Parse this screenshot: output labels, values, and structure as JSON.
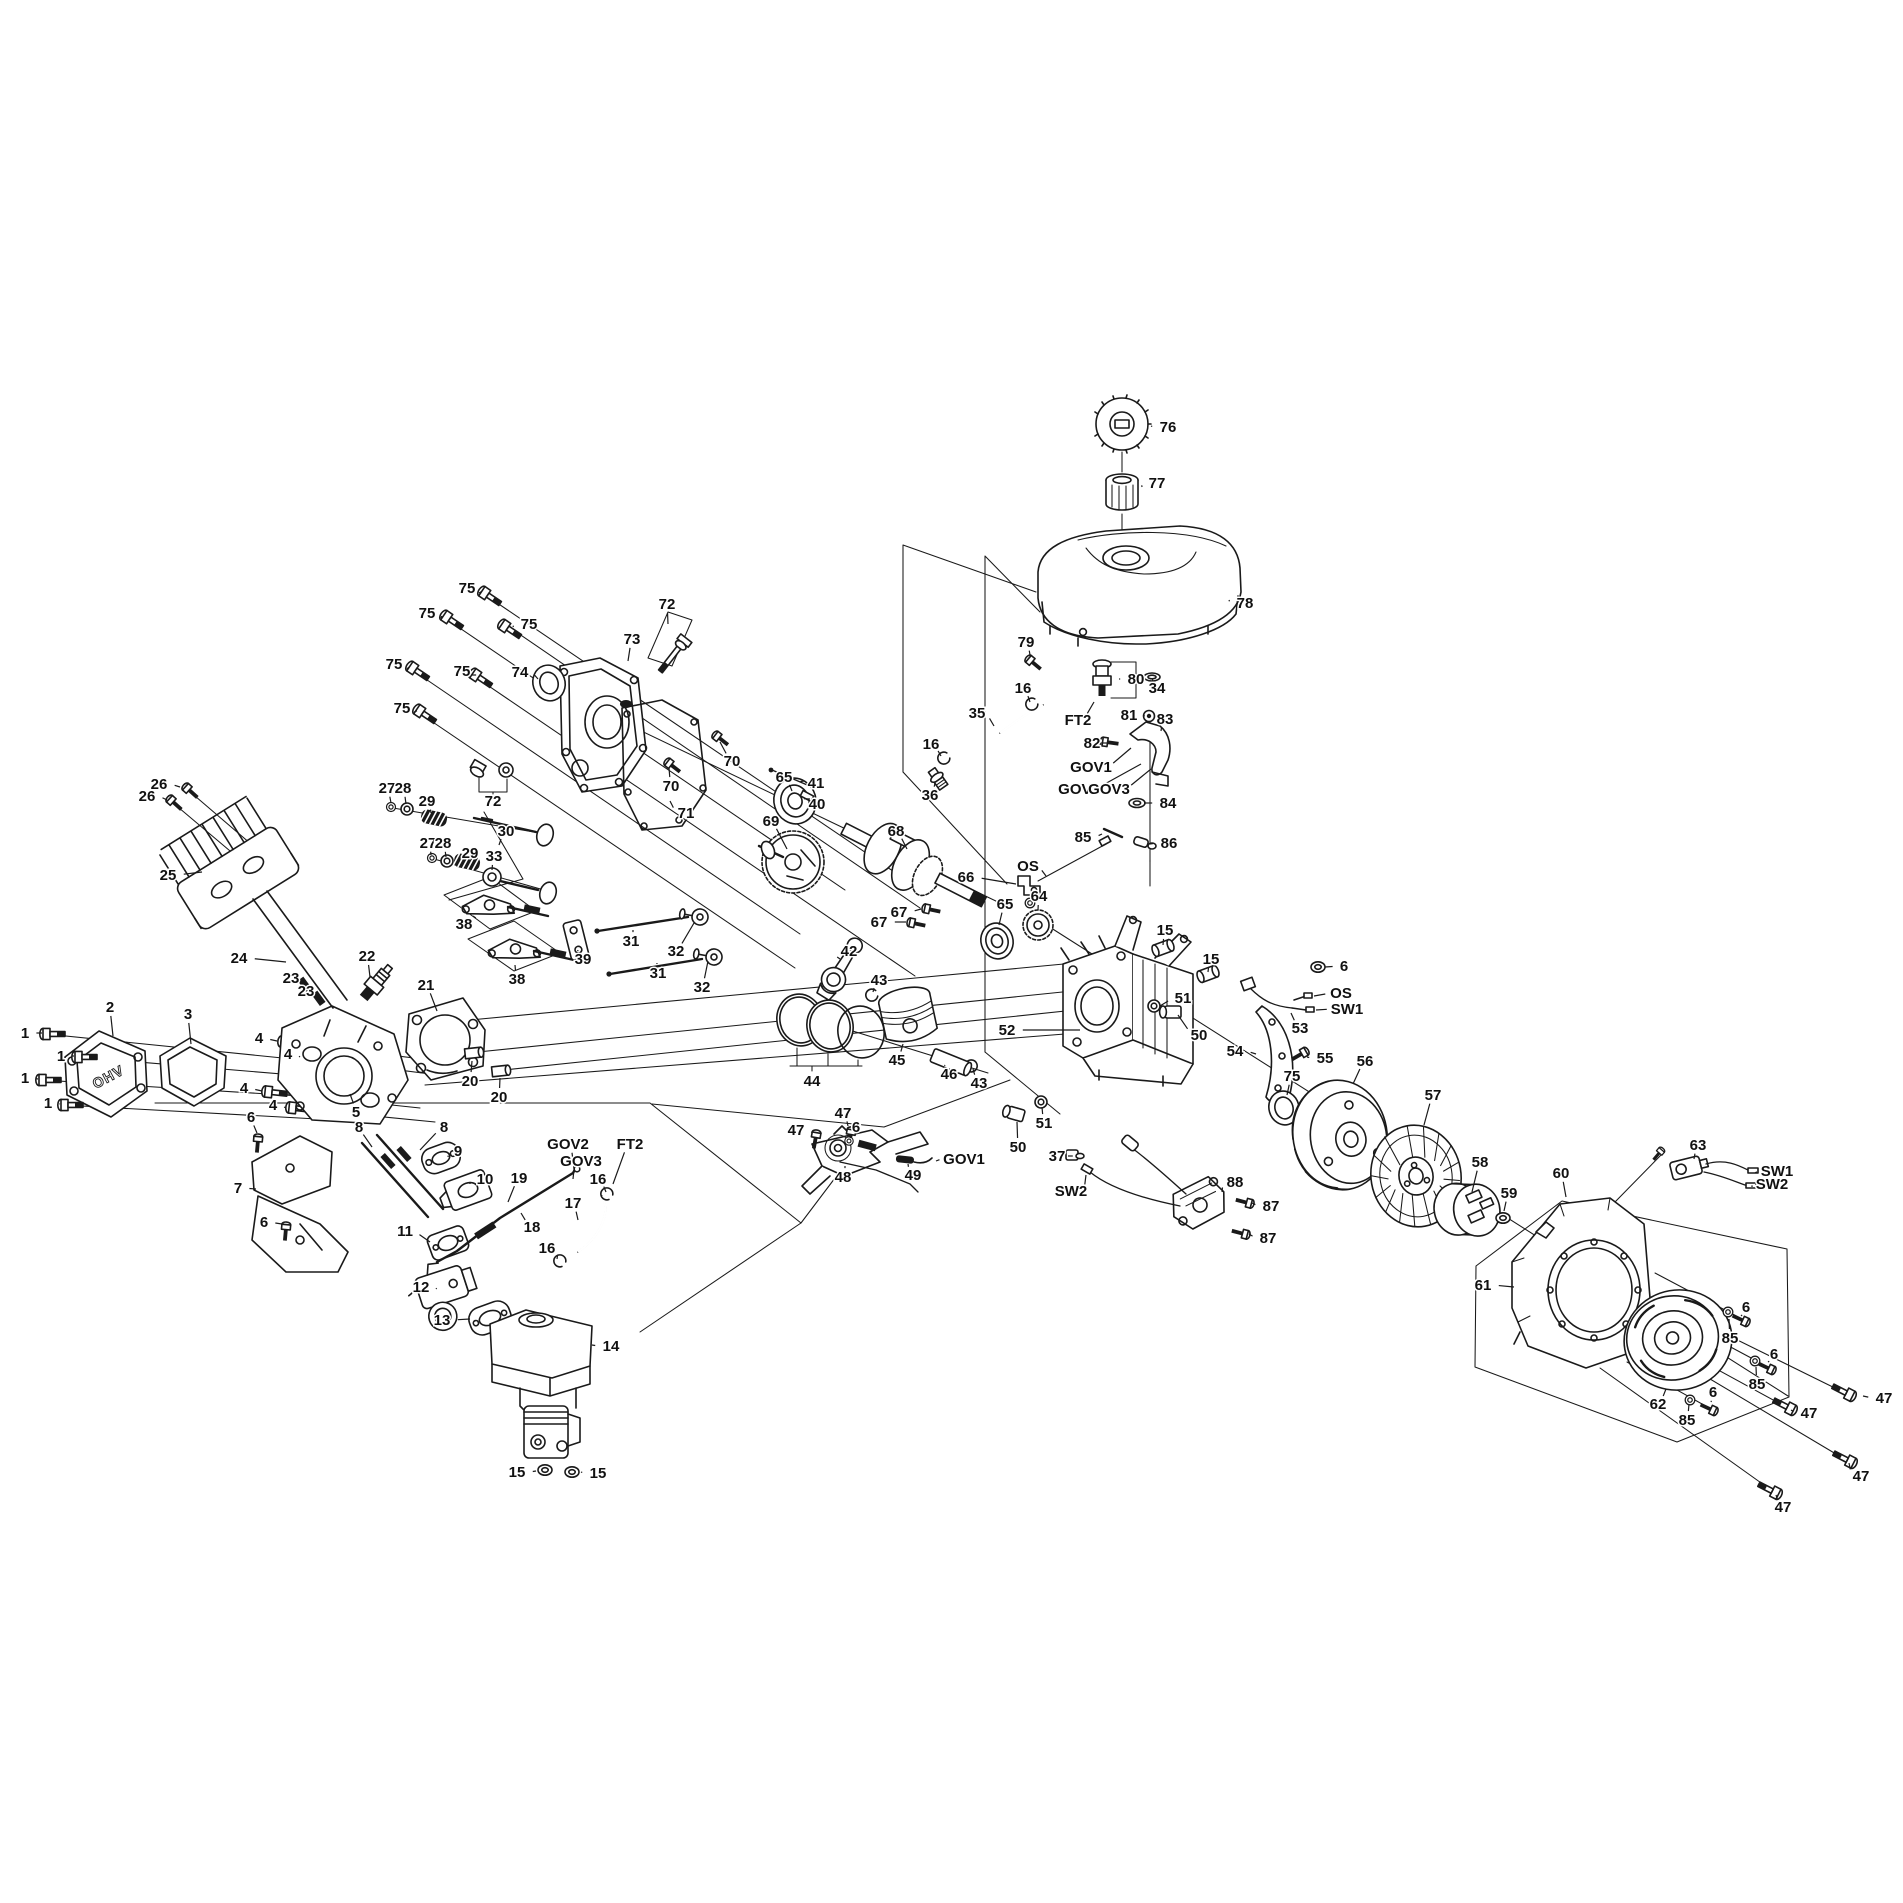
{
  "diagram": {
    "kind": "exploded-parts-diagram",
    "background": "#ffffff",
    "line_color": "#1a1a1a",
    "label_color": "#111111",
    "label_font_size": 15,
    "cover_text": "OHV"
  },
  "callouts": [
    {
      "t": "1",
      "x": 25,
      "y": 1033,
      "lx": 42,
      "ly": 1033
    },
    {
      "t": "1",
      "x": 61,
      "y": 1056,
      "lx": 74,
      "ly": 1056
    },
    {
      "t": "1",
      "x": 25,
      "y": 1078,
      "lx": 38,
      "ly": 1079
    },
    {
      "t": "1",
      "x": 48,
      "y": 1103,
      "lx": 60,
      "ly": 1104
    },
    {
      "t": "2",
      "x": 110,
      "y": 1007,
      "lx": 113,
      "ly": 1036
    },
    {
      "t": "3",
      "x": 188,
      "y": 1014,
      "lx": 191,
      "ly": 1044
    },
    {
      "t": "4",
      "x": 259,
      "y": 1038,
      "lx": 277,
      "ly": 1041
    },
    {
      "t": "4",
      "x": 288,
      "y": 1054,
      "lx": 300,
      "ly": 1057
    },
    {
      "t": "4",
      "x": 244,
      "y": 1088,
      "lx": 262,
      "ly": 1091
    },
    {
      "t": "4",
      "x": 273,
      "y": 1105,
      "lx": 286,
      "ly": 1108
    },
    {
      "t": "5",
      "x": 356,
      "y": 1112,
      "lx": 350,
      "ly": 1094
    },
    {
      "t": "6",
      "x": 251,
      "y": 1117,
      "lx": 257,
      "ly": 1133
    },
    {
      "t": "6",
      "x": 264,
      "y": 1222,
      "lx": 282,
      "ly": 1224
    },
    {
      "t": "6",
      "x": 856,
      "y": 1127,
      "lx": 850,
      "ly": 1138
    },
    {
      "t": "7",
      "x": 238,
      "y": 1188,
      "lx": 256,
      "ly": 1189
    },
    {
      "t": "8",
      "x": 359,
      "y": 1127,
      "lx": 372,
      "ly": 1147
    },
    {
      "t": "8",
      "x": 444,
      "y": 1127,
      "lx": 420,
      "ly": 1150
    },
    {
      "t": "9",
      "x": 458,
      "y": 1151,
      "lx": 448,
      "ly": 1157
    },
    {
      "t": "10",
      "x": 485,
      "y": 1179,
      "lx": 470,
      "ly": 1184
    },
    {
      "t": "11",
      "x": 405,
      "y": 1231,
      "lx": 430,
      "ly": 1242
    },
    {
      "t": "12",
      "x": 421,
      "y": 1287,
      "lx": 436,
      "ly": 1289
    },
    {
      "t": "13",
      "x": 442,
      "y": 1320,
      "lx": 470,
      "ly": 1319
    },
    {
      "t": "14",
      "x": 611,
      "y": 1346,
      "lx": 592,
      "ly": 1345
    },
    {
      "t": "15",
      "x": 517,
      "y": 1472,
      "lx": 536,
      "ly": 1471
    },
    {
      "t": "15",
      "x": 598,
      "y": 1473,
      "lx": 581,
      "ly": 1472
    },
    {
      "t": "15",
      "x": 1165,
      "y": 930,
      "lx": 1163,
      "ly": 945
    },
    {
      "t": "15",
      "x": 1211,
      "y": 959,
      "lx": 1208,
      "ly": 972
    },
    {
      "t": "16",
      "x": 1023,
      "y": 688,
      "lx": 1030,
      "ly": 702
    },
    {
      "t": "16",
      "x": 931,
      "y": 744,
      "lx": 941,
      "ly": 756
    },
    {
      "t": "16",
      "x": 598,
      "y": 1179,
      "lx": 606,
      "ly": 1192
    },
    {
      "t": "16",
      "x": 547,
      "y": 1248,
      "lx": 557,
      "ly": 1259
    },
    {
      "t": "17",
      "x": 573,
      "y": 1203,
      "lx": 578,
      "ly": 1220
    },
    {
      "t": "18",
      "x": 532,
      "y": 1227,
      "lx": 521,
      "ly": 1213
    },
    {
      "t": "19",
      "x": 519,
      "y": 1178,
      "lx": 508,
      "ly": 1202
    },
    {
      "t": "20",
      "x": 470,
      "y": 1081,
      "lx": 472,
      "ly": 1061
    },
    {
      "t": "20",
      "x": 499,
      "y": 1097,
      "lx": 500,
      "ly": 1078
    },
    {
      "t": "21",
      "x": 426,
      "y": 985,
      "lx": 437,
      "ly": 1011
    },
    {
      "t": "22",
      "x": 367,
      "y": 956,
      "lx": 370,
      "ly": 977
    },
    {
      "t": "23",
      "x": 291,
      "y": 978,
      "lx": 304,
      "ly": 988
    },
    {
      "t": "23",
      "x": 306,
      "y": 991,
      "lx": 318,
      "ly": 1001
    },
    {
      "t": "24",
      "x": 239,
      "y": 958,
      "lx": 286,
      "ly": 962
    },
    {
      "t": "25",
      "x": 168,
      "y": 875,
      "lx": 202,
      "ly": 872
    },
    {
      "t": "26",
      "x": 159,
      "y": 784,
      "lx": 180,
      "ly": 787
    },
    {
      "t": "26",
      "x": 147,
      "y": 796,
      "lx": 167,
      "ly": 800
    },
    {
      "t": "27",
      "x": 387,
      "y": 788,
      "lx": 391,
      "ly": 803
    },
    {
      "t": "27",
      "x": 428,
      "y": 843,
      "lx": 431,
      "ly": 855
    },
    {
      "t": "28",
      "x": 403,
      "y": 788,
      "lx": 406,
      "ly": 804
    },
    {
      "t": "28",
      "x": 443,
      "y": 843,
      "lx": 446,
      "ly": 857
    },
    {
      "t": "29",
      "x": 427,
      "y": 801,
      "lx": 431,
      "ly": 813
    },
    {
      "t": "29",
      "x": 470,
      "y": 853,
      "lx": 467,
      "ly": 858
    },
    {
      "t": "30",
      "x": 506,
      "y": 831,
      "lx": 499,
      "ly": 845
    },
    {
      "t": "31",
      "x": 631,
      "y": 941,
      "lx": 633,
      "ly": 930
    },
    {
      "t": "31",
      "x": 658,
      "y": 973,
      "lx": 657,
      "ly": 963
    },
    {
      "t": "32",
      "x": 676,
      "y": 951,
      "lx": 694,
      "ly": 923
    },
    {
      "t": "32",
      "x": 702,
      "y": 987,
      "lx": 708,
      "ly": 961
    },
    {
      "t": "33",
      "x": 494,
      "y": 856,
      "lx": 492,
      "ly": 870
    },
    {
      "t": "34",
      "x": 1157,
      "y": 688,
      "lx": 1153,
      "ly": 680
    },
    {
      "t": "35",
      "x": 977,
      "y": 713,
      "lx": 994,
      "ly": 726
    },
    {
      "t": "36",
      "x": 930,
      "y": 795,
      "lx": 935,
      "ly": 783
    },
    {
      "t": "37",
      "x": 1057,
      "y": 1156,
      "lx": 1068,
      "ly": 1156
    },
    {
      "t": "38",
      "x": 464,
      "y": 924,
      "lx": 473,
      "ly": 916
    },
    {
      "t": "38",
      "x": 517,
      "y": 979,
      "lx": 515,
      "ly": 965
    },
    {
      "t": "39",
      "x": 583,
      "y": 959,
      "lx": 578,
      "ly": 950
    },
    {
      "t": "40",
      "x": 817,
      "y": 804,
      "lx": 810,
      "ly": 799
    },
    {
      "t": "41",
      "x": 816,
      "y": 783,
      "lx": 804,
      "ly": 781
    },
    {
      "t": "42",
      "x": 849,
      "y": 951,
      "lx": 840,
      "ly": 959
    },
    {
      "t": "43",
      "x": 879,
      "y": 980,
      "lx": 873,
      "ly": 992
    },
    {
      "t": "43",
      "x": 979,
      "y": 1083,
      "lx": 973,
      "ly": 1069
    },
    {
      "t": "44",
      "x": 812,
      "y": 1081,
      "lx": null,
      "ly": null
    },
    {
      "t": "45",
      "x": 897,
      "y": 1060,
      "lx": 903,
      "ly": 1044
    },
    {
      "t": "46",
      "x": 949,
      "y": 1074,
      "lx": 945,
      "ly": 1065
    },
    {
      "t": "47",
      "x": 843,
      "y": 1113,
      "lx": 848,
      "ly": 1126
    },
    {
      "t": "47",
      "x": 796,
      "y": 1130,
      "lx": 812,
      "ly": 1133
    },
    {
      "t": "47",
      "x": 1884,
      "y": 1398,
      "lx": 1863,
      "ly": 1396
    },
    {
      "t": "47",
      "x": 1809,
      "y": 1413,
      "lx": 1791,
      "ly": 1410
    },
    {
      "t": "47",
      "x": 1861,
      "y": 1476,
      "lx": 1849,
      "ly": 1463
    },
    {
      "t": "47",
      "x": 1783,
      "y": 1507,
      "lx": 1776,
      "ly": 1495
    },
    {
      "t": "48",
      "x": 843,
      "y": 1177,
      "lx": 845,
      "ly": 1166
    },
    {
      "t": "49",
      "x": 913,
      "y": 1175,
      "lx": 908,
      "ly": 1164
    },
    {
      "t": "50",
      "x": 1199,
      "y": 1035,
      "lx": 1178,
      "ly": 1015
    },
    {
      "t": "50",
      "x": 1018,
      "y": 1147,
      "lx": 1017,
      "ly": 1122
    },
    {
      "t": "51",
      "x": 1183,
      "y": 998,
      "lx": 1160,
      "ly": 1006
    },
    {
      "t": "51",
      "x": 1044,
      "y": 1123,
      "lx": 1042,
      "ly": 1107
    },
    {
      "t": "52",
      "x": 1007,
      "y": 1030,
      "lx": 1080,
      "ly": 1030
    },
    {
      "t": "53",
      "x": 1300,
      "y": 1028,
      "lx": 1291,
      "ly": 1013
    },
    {
      "t": "54",
      "x": 1235,
      "y": 1051,
      "lx": 1256,
      "ly": 1054
    },
    {
      "t": "55",
      "x": 1325,
      "y": 1058,
      "lx": 1307,
      "ly": 1057
    },
    {
      "t": "56",
      "x": 1365,
      "y": 1061,
      "lx": 1353,
      "ly": 1084
    },
    {
      "t": "57",
      "x": 1433,
      "y": 1095,
      "lx": 1424,
      "ly": 1125
    },
    {
      "t": "58",
      "x": 1480,
      "y": 1162,
      "lx": 1472,
      "ly": 1192
    },
    {
      "t": "59",
      "x": 1509,
      "y": 1193,
      "lx": 1504,
      "ly": 1211
    },
    {
      "t": "60",
      "x": 1561,
      "y": 1173,
      "lx": 1566,
      "ly": 1197
    },
    {
      "t": "61",
      "x": 1483,
      "y": 1285,
      "lx": 1514,
      "ly": 1287
    },
    {
      "t": "62",
      "x": 1658,
      "y": 1404,
      "lx": 1666,
      "ly": 1389
    },
    {
      "t": "63",
      "x": 1698,
      "y": 1145,
      "lx": 1694,
      "ly": 1159
    },
    {
      "t": "64",
      "x": 1039,
      "y": 896,
      "lx": 1038,
      "ly": 910
    },
    {
      "t": "65",
      "x": 784,
      "y": 777,
      "lx": 792,
      "ly": 791
    },
    {
      "t": "65",
      "x": 1005,
      "y": 904,
      "lx": 999,
      "ly": 925
    },
    {
      "t": "66",
      "x": 966,
      "y": 877,
      "lx": 1016,
      "ly": 884
    },
    {
      "t": "67",
      "x": 899,
      "y": 912,
      "lx": 921,
      "ly": 909
    },
    {
      "t": "67",
      "x": 879,
      "y": 922,
      "lx": 906,
      "ly": 922
    },
    {
      "t": "68",
      "x": 896,
      "y": 831,
      "lx": 907,
      "ly": 849
    },
    {
      "t": "69",
      "x": 771,
      "y": 821,
      "lx": 787,
      "ly": 849
    },
    {
      "t": "70",
      "x": 732,
      "y": 761,
      "lx": 720,
      "ly": 742
    },
    {
      "t": "70",
      "x": 671,
      "y": 786,
      "lx": 669,
      "ly": 768
    },
    {
      "t": "71",
      "x": 686,
      "y": 813,
      "lx": 670,
      "ly": 801
    },
    {
      "t": "72",
      "x": 667,
      "y": 604,
      "lx": 668,
      "ly": 624
    },
    {
      "t": "72",
      "x": 493,
      "y": 801,
      "lx": null,
      "ly": null
    },
    {
      "t": "73",
      "x": 632,
      "y": 639,
      "lx": 628,
      "ly": 661
    },
    {
      "t": "74",
      "x": 520,
      "y": 672,
      "lx": 538,
      "ly": 679
    },
    {
      "t": "75",
      "x": 467,
      "y": 588,
      "lx": 479,
      "ly": 593
    },
    {
      "t": "75",
      "x": 427,
      "y": 613,
      "lx": 441,
      "ly": 618
    },
    {
      "t": "75",
      "x": 529,
      "y": 624,
      "lx": 513,
      "ly": 627
    },
    {
      "t": "75",
      "x": 394,
      "y": 664,
      "lx": 407,
      "ly": 669
    },
    {
      "t": "75",
      "x": 462,
      "y": 671,
      "lx": 470,
      "ly": 675
    },
    {
      "t": "75",
      "x": 402,
      "y": 708,
      "lx": 414,
      "ly": 712
    },
    {
      "t": "75",
      "x": 1292,
      "y": 1076,
      "lx": 1287,
      "ly": 1095
    },
    {
      "t": "76",
      "x": 1168,
      "y": 427,
      "lx": 1151,
      "ly": 426
    },
    {
      "t": "77",
      "x": 1157,
      "y": 483,
      "lx": 1142,
      "ly": 487
    },
    {
      "t": "78",
      "x": 1245,
      "y": 603,
      "lx": 1229,
      "ly": 600
    },
    {
      "t": "79",
      "x": 1026,
      "y": 642,
      "lx": 1030,
      "ly": 655
    },
    {
      "t": "80",
      "x": 1136,
      "y": 679,
      "lx": 1119,
      "ly": 679
    },
    {
      "t": "81",
      "x": 1129,
      "y": 715,
      "lx": 1143,
      "ly": 716
    },
    {
      "t": "82",
      "x": 1092,
      "y": 743,
      "lx": 1101,
      "ly": 743
    },
    {
      "t": "83",
      "x": 1165,
      "y": 719,
      "lx": 1161,
      "ly": 731
    },
    {
      "t": "84",
      "x": 1168,
      "y": 803,
      "lx": 1144,
      "ly": 803
    },
    {
      "t": "85",
      "x": 1083,
      "y": 837,
      "lx": 1102,
      "ly": 834
    },
    {
      "t": "86",
      "x": 1169,
      "y": 843,
      "lx": 1150,
      "ly": 844
    },
    {
      "t": "85",
      "x": 1730,
      "y": 1338,
      "lx": 1729,
      "ly": 1319
    },
    {
      "t": "85",
      "x": 1757,
      "y": 1384,
      "lx": 1756,
      "ly": 1367
    },
    {
      "t": "85",
      "x": 1687,
      "y": 1420,
      "lx": 1689,
      "ly": 1404
    },
    {
      "t": "6",
      "x": 1746,
      "y": 1307,
      "lx": 1741,
      "ly": 1316
    },
    {
      "t": "6",
      "x": 1774,
      "y": 1354,
      "lx": 1768,
      "ly": 1362
    },
    {
      "t": "6",
      "x": 1713,
      "y": 1392,
      "lx": 1711,
      "ly": 1402
    },
    {
      "t": "6",
      "x": 1344,
      "y": 966,
      "lx": 1325,
      "ly": 967
    },
    {
      "t": "87",
      "x": 1271,
      "y": 1206,
      "lx": 1252,
      "ly": 1203
    },
    {
      "t": "87",
      "x": 1268,
      "y": 1238,
      "lx": 1249,
      "ly": 1234
    },
    {
      "t": "88",
      "x": 1235,
      "y": 1182,
      "lx": 1222,
      "ly": 1192
    },
    {
      "t": "GOV1",
      "x": 1091,
      "y": 767,
      "lx": 1131,
      "ly": 748
    },
    {
      "t": "GOV2",
      "x": 1079,
      "y": 789,
      "lx": 1141,
      "ly": 764
    },
    {
      "t": "GOV3",
      "x": 1109,
      "y": 789,
      "lx": 1151,
      "ly": 769
    },
    {
      "t": "GOV1",
      "x": 964,
      "y": 1159,
      "lx": 936,
      "ly": 1161
    },
    {
      "t": "GOV2",
      "x": 568,
      "y": 1144,
      "lx": 574,
      "ly": 1169
    },
    {
      "t": "GOV3",
      "x": 581,
      "y": 1161,
      "lx": 573,
      "ly": 1179
    },
    {
      "t": "FT2",
      "x": 1078,
      "y": 720,
      "lx": 1094,
      "ly": 702
    },
    {
      "t": "FT2",
      "x": 630,
      "y": 1144,
      "lx": 613,
      "ly": 1184
    },
    {
      "t": "OS",
      "x": 1028,
      "y": 866,
      "lx": 1046,
      "ly": 876
    },
    {
      "t": "OS",
      "x": 1341,
      "y": 993,
      "lx": 1314,
      "ly": 996
    },
    {
      "t": "SW1",
      "x": 1347,
      "y": 1009,
      "lx": 1316,
      "ly": 1010
    },
    {
      "t": "SW2",
      "x": 1071,
      "y": 1191,
      "lx": 1086,
      "ly": 1175
    },
    {
      "t": "SW1",
      "x": 1777,
      "y": 1171,
      "lx": 1755,
      "ly": 1173
    },
    {
      "t": "SW2",
      "x": 1772,
      "y": 1184,
      "lx": 1752,
      "ly": 1187
    }
  ]
}
